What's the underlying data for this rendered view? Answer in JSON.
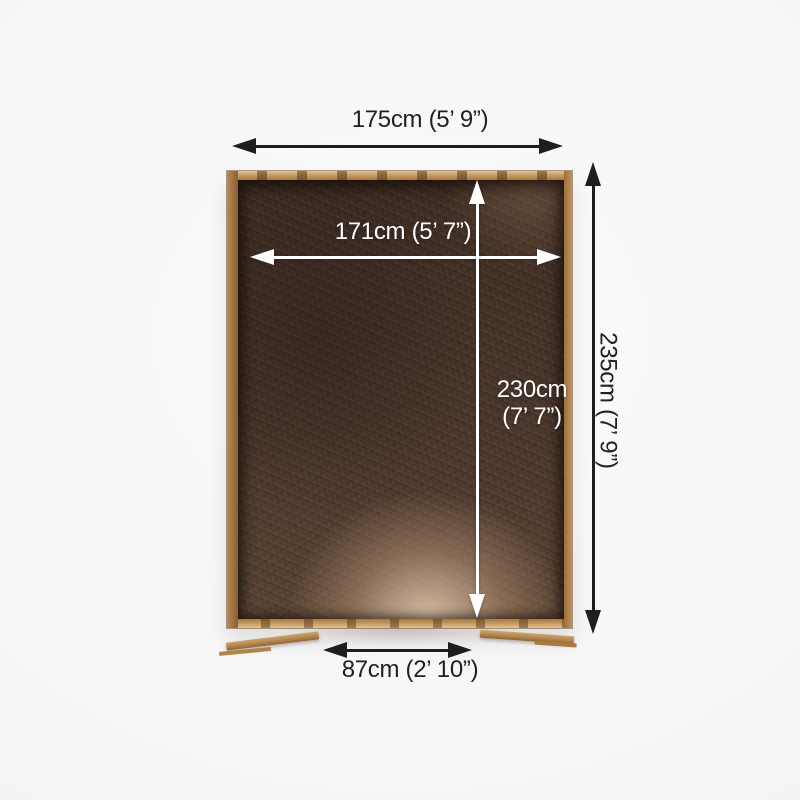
{
  "diagram": {
    "subject": "shed-floor-plan-top-view",
    "dimensions": {
      "outer_width": "175cm (5’ 9”)",
      "outer_depth": "235cm (7’ 9”)",
      "inner_width": "171cm (5’ 7”)",
      "inner_depth_line1": "230cm",
      "inner_depth_line2": "(7’ 7”)",
      "door_width": "87cm (2’ 10”)"
    },
    "colors": {
      "arrow_dark": "#1e1e1e",
      "arrow_light": "#ffffff",
      "text_dark": "#212121",
      "text_light": "#ffffff",
      "frame_wood": "#c49a60",
      "floor_base": "#49352a",
      "floor_highlight": "#cdb197",
      "background": "#f5f5f6"
    }
  }
}
